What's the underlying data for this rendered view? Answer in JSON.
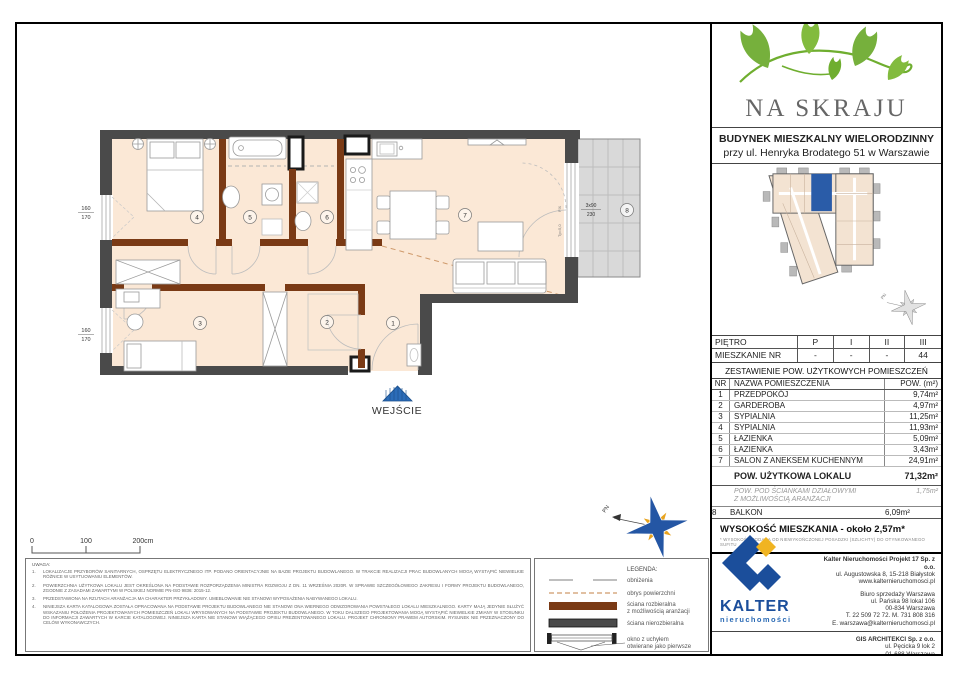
{
  "branding": {
    "logo_title": "NA SKRAJU",
    "building_line1": "BUDYNEK MIESZKALNY WIELORODZINNY",
    "building_line2": "przy ul. Henryka Brodatego 51 w Warszawie"
  },
  "floor_table": {
    "rows": [
      {
        "label": "PIĘTRO",
        "c0": "P",
        "c1": "I",
        "c2": "II",
        "c3": "III"
      },
      {
        "label": "MIESZKANIE NR",
        "c0": "-",
        "c1": "-",
        "c2": "-",
        "c3": "44"
      }
    ]
  },
  "rooms_table": {
    "title": "ZESTAWIENIE POW. UŻYTKOWYCH POMIESZCZEŃ",
    "col_nr": "NR",
    "col_name": "NAZWA POMIESZCZENIA",
    "col_area": "POW. (m²)",
    "rows": [
      {
        "nr": "1",
        "name": "PRZEDPOKÓJ",
        "area": "9,74m²"
      },
      {
        "nr": "2",
        "name": "GARDEROBA",
        "area": "4,97m²"
      },
      {
        "nr": "3",
        "name": "SYPIALNIA",
        "area": "11,25m²"
      },
      {
        "nr": "4",
        "name": "SYPIALNIA",
        "area": "11,93m²"
      },
      {
        "nr": "5",
        "name": "ŁAZIENKA",
        "area": "5,09m²"
      },
      {
        "nr": "6",
        "name": "ŁAZIENKA",
        "area": "3,43m²"
      },
      {
        "nr": "7",
        "name": "SALON Z ANEKSEM KUCHENNYM",
        "area": "24,91m²"
      }
    ],
    "total_label": "POW. UŻYTKOWA LOKALU",
    "total_value": "71,32m²",
    "partition_line1": "POW. POD ŚCIANKAMI DZIAŁOWYMI",
    "partition_line2": "Z MOŻLIWOŚCIĄ ARANŻACJI",
    "partition_value": "1,75m²",
    "balcony_nr": "8",
    "balcony_name": "BALKON",
    "balcony_value": "6,09m²",
    "height_text": "WYSOKOŚĆ MIESZKANIA - około 2,57m*",
    "height_footnote": "* WYSOKOŚĆ PODANA OD NIEWYKOŃCZONEJ POSADZKI (SZLICHTY) DO OTYNKOWANEGO SUFITU"
  },
  "companies": {
    "kalter_logo_text": "KALTER",
    "kalter_logo_sub": "nieruchomości",
    "hq_name": "Kalter Nieruchomości Projekt 17 Sp. z o.o.",
    "hq_addr": "ul. Augustowska 8, 15-218 Białystok",
    "hq_web": "www.kalternieruchomosci.pl",
    "office_line1": "Biuro sprzedaży Warszawa",
    "office_line2": "ul. Pańska 98 lokal 106",
    "office_line3": "00-834 Warszawa",
    "office_line4": "T. 22 509 72 72. M. 731 808 316",
    "office_line5": "E. warszawa@kalternieruchomosci.pl",
    "gis_name": "GIS ARCHITEKCI Sp. z o.o.",
    "gis_line1": "ul. Pęcicka 9 lok 2",
    "gis_line2": "01-688 Warszawa",
    "gis_line3": "www.gisarchitekci.pl"
  },
  "legend": {
    "title": "LEGENDA:",
    "item1": "obniżenia",
    "item2": "obrys powierzchni",
    "item3a": "ściana rozbieralna",
    "item3b": "z możliwością aranżacji",
    "item4": "ściana nierozbieralna",
    "item5a": "okno z uchyłem",
    "item5b": "otwierane jako pierwsze"
  },
  "notes": {
    "title": "UWAGA:",
    "n1": "1.",
    "n2": "2.",
    "n3": "3.",
    "n4": "4.",
    "item1": "LOKALIZACJE PRZYBORÓW SANITARNYCH, OSPRZĘTU ELEKTRYCZNEGO ITP. PODANO ORIENTACYJNIE NA BAZIE PROJEKTU BUDOWLANEGO. W TRAKCIE REALIZACJI PRAC BUDOWLANYCH MOGĄ WYSTĄPIĆ NIEWIELKIE RÓŻNICE W USYTUOWANIU ELEMENTÓW.",
    "item2": "POWIERZCHNIA UŻYTKOWA LOKALU JEST OKREŚLONA NA PODSTAWIE ROZPORZĄDZENIA MINISTRA ROZWOJU Z DN. 11 WRZEŚNIA 2020R. W SPRAWIE SZCZEGÓŁOWEGO ZAKRESU I FORMY PROJEKTU BUDOWLANEGO, ZGODNIE Z ZASADAMI ZAWARTYMI W POLSKIEJ NORMIE PN-ISO 9836: 2015-12.",
    "item3": "PRZEDSTAWIONA NA RZUTACH ARANŻACJA MA CHARAKTER PRZYKŁADOWY. UMEBLOWANIE NIE STANOWI WYPOSAŻENIA NABYWANEGO LOKALU.",
    "item4": "NINIEJSZA KARTA KATALOGOWA ZOSTAŁA OPRACOWANA NA PODSTAWIE PROJEKTU BUDOWLANEGO NIE STANOWI ONA WIERNEGO ODWZOROWANIA POWSTAŁEGO LOKALU MIESZKALNEGO. KARTY MAJĄ JEDYNIE SŁUŻYĆ WSKAZANIU POŁOŻENIA PROJEKTOWANYCH POMIESZCZEŃ LOKALI WRYSOWANYCH NA PODSTAWIE PROJEKTU BUDOWLANEGO. W TOKU DALSZEGO PROJEKTOWANIA MOGĄ WYSTĄPIĆ NIEWIELKIE ZMIANY W STOSUNKU DO INFORMACJI ZAWARTYCH W KARCIE KATALOGOWEJ. NINIEJSZA KARTA NIE STANOWI WIĄŻĄCEGO OPISU PREZENTOWANEGO LOKALU. PROJEKT CHRONIONY PRAWEM AUTORSKIM. RYSUNEK NIE PRZEZNACZONY DO CELÓW WYKONAWCZYCH."
  },
  "plan": {
    "entrance_label": "WEJŚCIE",
    "room_numbers": {
      "r1": "1",
      "r2": "2",
      "r3": "3",
      "r4": "4",
      "r5": "5",
      "r6": "6",
      "r7": "7",
      "r8": "8"
    },
    "window_dim_top": "160",
    "window_dim_bottom": "170",
    "balcony_dim_top": "3x90",
    "balcony_dim_bottom": "230",
    "fix_label": "FIX",
    "door_label": "Tp=5,0",
    "north_label": "PN",
    "scale_0": "0",
    "scale_100": "100",
    "scale_200": "200cm"
  },
  "colors": {
    "wall_outer": "#4a4a4a",
    "wall_partition": "#7a3a15",
    "floor_fill": "#fbe8d6",
    "balcony_fill": "#d9d9d9",
    "outline_dash": "#cf9a6b",
    "accent_green": "#76b03c",
    "unit_blue": "#2a5ca8",
    "kalter_blue": "#1b4e9b",
    "kalter_yellow": "#f0b422"
  }
}
